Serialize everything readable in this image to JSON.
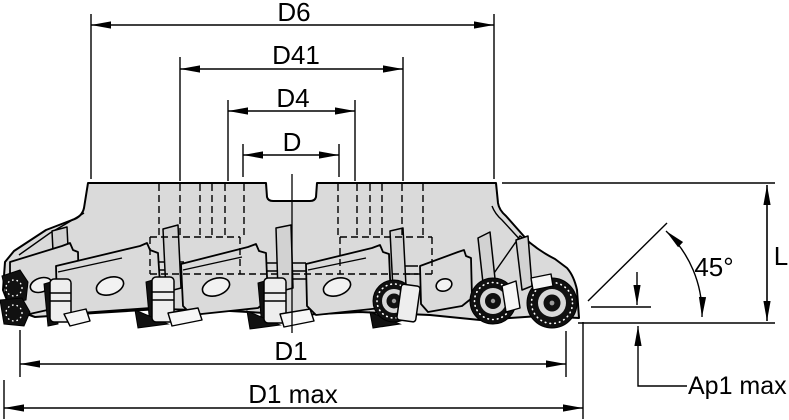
{
  "diagram": {
    "type": "technical-dimension-drawing",
    "subject": "45-degree face milling cutter, side view with dimension callouts",
    "labels": {
      "d6": "D6",
      "d41": "D41",
      "d4": "D4",
      "d": "D",
      "d1": "D1",
      "d1_max": "D1 max",
      "length": "L",
      "angle": "45°",
      "ap1_max": "Ap1 max"
    },
    "colors": {
      "line": "#000000",
      "body_fill": "#dadada",
      "insert_dark": "#111111",
      "background": "#ffffff"
    }
  }
}
